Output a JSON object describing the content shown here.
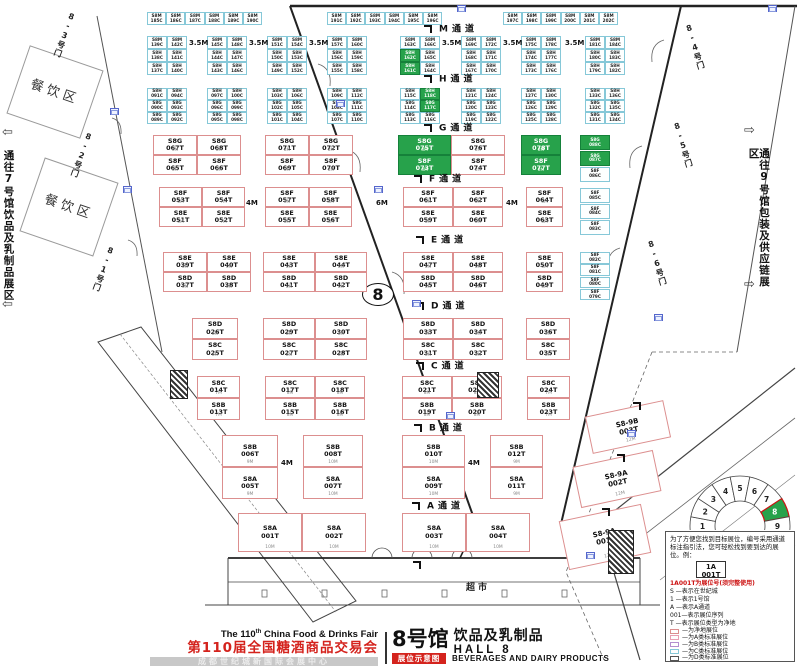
{
  "colors": {
    "booth_t_border": "#dc8f8f",
    "booth_c_border": "#86c8d8",
    "highlight_green": "#27a24b",
    "brand_red": "#d4231d",
    "legend_red": "#cc1111"
  },
  "hall_number": "8",
  "aisles": [
    "M通道",
    "H通道",
    "G通道",
    "F通道",
    "E通道",
    "D通道",
    "C通道",
    "B通道",
    "A通道"
  ],
  "doors": [
    "8-3号门",
    "8-2号门",
    "8-1号门",
    "8-4号门",
    "8-5号门",
    "8-6号门"
  ],
  "corridors": {
    "left": "通往7号馆饮品及乳制品展区",
    "right": "通往9号馆包装及供应链展区",
    "left_arrow": "⇦",
    "right_arrow": "⇨"
  },
  "areas": [
    "餐饮区",
    "餐饮区"
  ],
  "market_label": "超市",
  "gap_labels": {
    "mh": "3.5M",
    "fe": [
      "4M",
      "6M",
      "4M"
    ],
    "ba": [
      "4M",
      "4M"
    ]
  },
  "top_row": [
    [
      "S8M 185C",
      "S8M 186C",
      "S8M 187C",
      "S8M 188C",
      "S8M 189C",
      "S8M 190C"
    ],
    [
      "S8M 191C",
      "S8M 192C",
      "S8M 193C",
      "S8M 194C",
      "S8M 195C",
      "S8M 196C"
    ],
    [
      "S8M 197C",
      "S8M 198C",
      "S8M 199C",
      "S8M 200C",
      "S8M 201C",
      "S8M 202C"
    ]
  ],
  "mh_band": [
    [
      [
        "S8M 139C",
        "S8M 142C"
      ],
      [
        "S8H 138C",
        "S8H 141C"
      ],
      [
        "S8H 137C",
        "S8H 140C"
      ]
    ],
    [
      [
        "S8M 145C",
        "S8M 148C"
      ],
      [
        "S8H 144C",
        "S8H 147C"
      ],
      [
        "S8H 143C",
        "S8H 146C"
      ]
    ],
    [
      [
        "S8M 151C",
        "S8M 154C"
      ],
      [
        "S8H 150C",
        "S8H 153C"
      ],
      [
        "S8H 149C",
        "S8H 152C"
      ]
    ],
    [
      [
        "S8M 157C",
        "S8M 160C"
      ],
      [
        "S8H 156C",
        "S8H 159C"
      ],
      [
        "S8H 155C",
        "S8H 158C"
      ]
    ],
    [
      [
        "S8M 163C",
        "S8M 166C"
      ],
      [
        "S8H 162C*",
        "S8H 165C"
      ],
      [
        "S8H 161C*",
        "S8H 164C"
      ]
    ],
    [
      [
        "S8M 169C",
        "S8M 172C"
      ],
      [
        "S8H 168C",
        "S8H 171C"
      ],
      [
        "S8H 167C",
        "S8H 170C"
      ]
    ],
    [
      [
        "S8M 175C",
        "S8M 178C"
      ],
      [
        "S8H 174C",
        "S8H 177C"
      ],
      [
        "S8H 173C",
        "S8H 176C"
      ]
    ],
    [
      [
        "S8M 181C",
        "S8M 184C"
      ],
      [
        "S8H 180C",
        "S8H 183C"
      ],
      [
        "S8H 179C",
        "S8H 182C"
      ]
    ]
  ],
  "h_band": [
    [
      [
        "S8H 091C",
        "S8H 094C"
      ],
      [
        "S8G 090C",
        "S8G 093C"
      ],
      [
        "S8G 089C",
        "S8G 092C"
      ]
    ],
    [
      [
        "S8H 097C",
        "S8H 100C"
      ],
      [
        "S8G 096C",
        "S8G 099C"
      ],
      [
        "S8G 095C",
        "S8G 098C"
      ]
    ],
    [
      [
        "S8H 103C",
        "S8H 106C"
      ],
      [
        "S8G 102C",
        "S8G 105C"
      ],
      [
        "S8G 101C",
        "S8G 104C"
      ]
    ],
    [
      [
        "S8H 109C",
        "S8H 112C"
      ],
      [
        "S8G 108C",
        "S8G 111C"
      ],
      [
        "S8G 107C",
        "S8G 110C"
      ]
    ],
    [
      [
        "S8H 115C",
        "S8H 118C*"
      ],
      [
        "S8G 114C",
        "S8G 117C*"
      ],
      [
        "S8G 113C",
        "S8G 116C"
      ]
    ],
    [
      [
        "S8H 121C",
        "S8H 124C"
      ],
      [
        "S8G 120C",
        "S8G 123C"
      ],
      [
        "S8G 119C",
        "S8G 122C"
      ]
    ],
    [
      [
        "S8H 127C",
        "S8H 130C"
      ],
      [
        "S8G 126C",
        "S8G 129C"
      ],
      [
        "S8G 125C",
        "S8G 128C"
      ]
    ],
    [
      [
        "S8H 133C",
        "S8H 136C"
      ],
      [
        "S8G 132C",
        "S8G 135C"
      ],
      [
        "S8G 131C",
        "S8G 134C"
      ]
    ]
  ],
  "side_c": [
    [
      "S8G 088C*",
      "S8G 087C*",
      "S8F 086C"
    ],
    [
      "S8F 085C",
      "S8F 084C",
      "S8F 083C"
    ],
    [
      "S8F 082C",
      "S8F 081C",
      "S8F 080C",
      "S8F 079C"
    ]
  ],
  "bands": {
    "gf": [
      [
        [
          "S8G 067T",
          "S8F 065T",
          "6M"
        ],
        [
          "S8G 068T",
          "S8F 066T",
          "8M"
        ]
      ],
      [
        [
          "S8G 071T",
          "S8F 069T",
          "8M"
        ],
        [
          "S8G 072T",
          "S8F 070T",
          "8M"
        ]
      ],
      [
        [
          "S8G 075T*",
          "S8F 073T*",
          "8M"
        ],
        [
          "S8G 076T",
          "S8F 074T",
          "8M"
        ]
      ],
      [
        [
          "S8G 078T*",
          "S8F 077T*",
          "8M"
        ]
      ]
    ],
    "fe": [
      [
        [
          "S8F 053T",
          "S8E 051T",
          "6M"
        ],
        [
          "S8F 054T",
          "S8E 052T",
          "7M"
        ]
      ],
      [
        [
          "S8F 057T",
          "S8E 055T",
          "8M"
        ],
        [
          "S8F 058T",
          "S8E 056T",
          "8M"
        ]
      ],
      [
        [
          "S8F 061T",
          "S8E 059T",
          "8M"
        ],
        [
          "S8F 062T",
          "S8E 060T",
          "8M"
        ]
      ],
      [
        [
          "S8F 064T",
          "S8E 063T",
          "6M"
        ]
      ]
    ],
    "ed": [
      [
        [
          "S8E 039T",
          "S8D 037T",
          "6M"
        ],
        [
          "S8E 040T",
          "S8D 038T",
          "6M"
        ]
      ],
      [
        [
          "S8E 043T",
          "S8D 041T",
          "8M"
        ],
        [
          "S8E 044T",
          "S8D 042T",
          "8M"
        ]
      ],
      [
        [
          "S8E 047T",
          "S8D 045T",
          "8M"
        ],
        [
          "S8E 048T",
          "S8D 046T",
          "8M"
        ]
      ],
      [
        [
          "S8E 050T",
          "S8D 049T",
          "6M"
        ]
      ]
    ],
    "dc": [
      [
        [
          "S8D 026T",
          "S8C 025T",
          "8M"
        ]
      ],
      [
        [
          "S8D 029T",
          "S8C 027T",
          "8M"
        ],
        [
          "S8D 030T",
          "S8C 028T",
          "8M"
        ]
      ],
      [
        [
          "S8D 033T",
          "S8C 031T",
          "8M"
        ],
        [
          "S8D 034T",
          "S8C 032T",
          "8M"
        ]
      ],
      [
        [
          "S8D 036T",
          "S8C 035T",
          "8M"
        ]
      ]
    ],
    "cb": [
      [
        [
          "S8C 014T",
          "S8B 013T",
          "7M"
        ]
      ],
      [
        [
          "S8C 017T",
          "S8B 015T",
          "8M"
        ],
        [
          "S8C 018T",
          "S8B 016T",
          "8M"
        ]
      ],
      [
        [
          "S8C 021T",
          "S8B 019T",
          "8M"
        ],
        [
          "S8C 022T",
          "S8B 020T",
          "8M"
        ]
      ],
      [
        [
          "S8C 024T",
          "S8B 023T",
          "7M"
        ]
      ]
    ],
    "ba": [
      [
        [
          "S8B 006T",
          "S8A 005T",
          "9M"
        ]
      ],
      [
        [
          "S8B 008T",
          "S8A 007T",
          "10M"
        ]
      ],
      [
        [
          "S8B 010T",
          "S8A 009T",
          "10M"
        ]
      ],
      [
        [
          "S8B 012T",
          "S8A 011T",
          "9M"
        ]
      ]
    ],
    "a": [
      [
        [
          "S8A 001T",
          "10M"
        ],
        [
          "S8A 002T",
          "10M"
        ]
      ],
      [
        [
          "S8A 003T",
          "10M"
        ],
        [
          "S8A 004T",
          "10M"
        ]
      ]
    ]
  },
  "s89": [
    {
      "label": "S8-9B 003T",
      "dim": "12M"
    },
    {
      "label": "S8-9A 002T",
      "dim": "12M"
    },
    {
      "label": "S8-9A 001T",
      "dim": "12M"
    }
  ],
  "fan": {
    "numbers": [
      "1",
      "2",
      "3",
      "4",
      "5",
      "6",
      "7",
      "8",
      "9"
    ],
    "highlight": "8"
  },
  "legend": {
    "intro": "为了方便您找到目标展位，编号采用通道标注指引法，您可轻松找到要到达的展位。例：",
    "example_line1": "1A",
    "example_line2": "001T",
    "note": "1A001T为展位号(须完整使用)",
    "items": [
      "S —表示在世纪城",
      "1 —表示1号馆",
      "A —表示A通道",
      "001—表示展位序列",
      "T —表示展位类型为净地"
    ],
    "swatches": [
      {
        "label": "—为净地展位",
        "color": "#dc8f8f"
      },
      {
        "label": "—为A类标准展位",
        "color": "#e8a0b4"
      },
      {
        "label": "—为B类标准展位",
        "color": "#b48fd0"
      },
      {
        "label": "—为C类标准展位",
        "color": "#86c8d8"
      },
      {
        "label": "—为D类标准展位",
        "color": "#555555"
      }
    ],
    "fire_note": "消防设施严禁遮挡"
  },
  "footer": {
    "fair_en_prefix": "The 110",
    "fair_en_sup": "th",
    "fair_en_suffix": " China Food & Drinks Fair",
    "fair_cn": "第110届全国糖酒商品交易会",
    "venue": "成都世纪城新国际会展中心",
    "hall_cn": "8号馆",
    "hall_products_cn": "饮品及乳制品",
    "hall_en": "HALL 8",
    "badge": "展位示意图",
    "products_en": "BEVERAGES AND DAIRY PRODUCTS"
  }
}
